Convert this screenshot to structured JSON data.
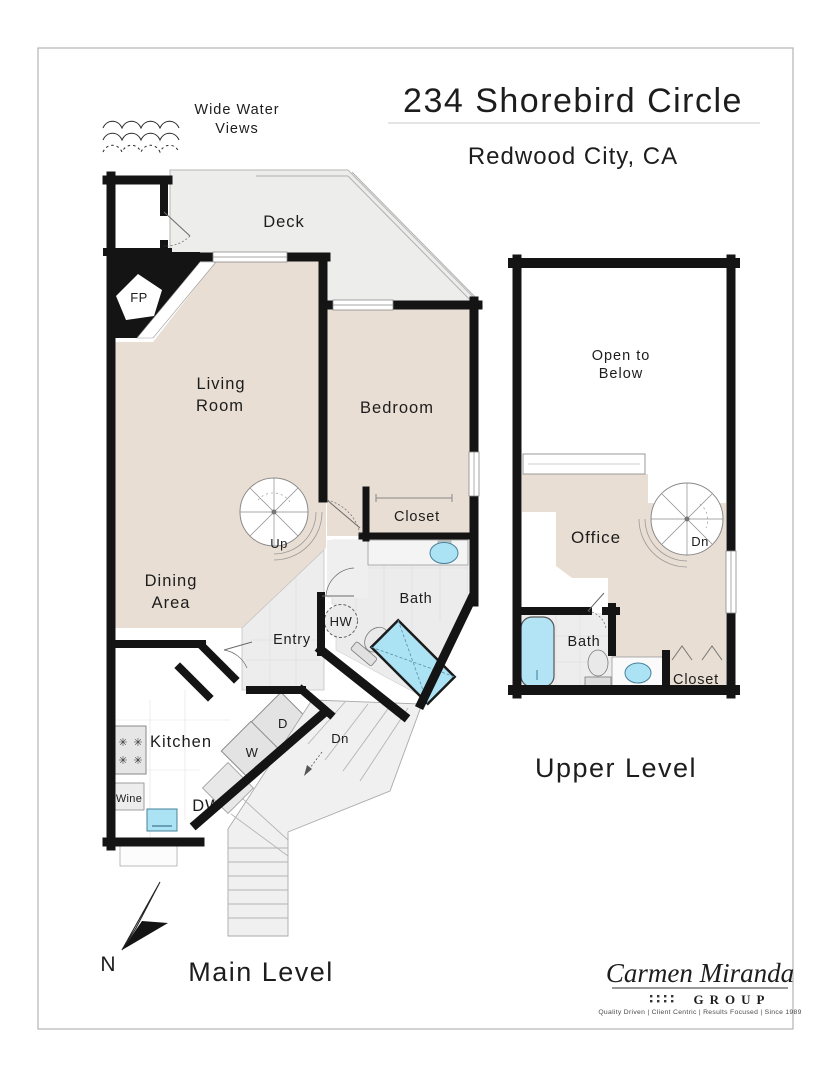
{
  "header": {
    "title": "234 Shorebird Circle",
    "subtitle": "Redwood City, CA"
  },
  "annotation": {
    "line1": "Wide Water",
    "line2": "Views"
  },
  "main_level": {
    "caption": "Main Level",
    "compass": "N",
    "rooms": {
      "closet": "Closet",
      "deck": "Deck",
      "fireplace": "FP",
      "living_1": "Living",
      "living_2": "Room",
      "bedroom": "Bedroom",
      "bedroom_closet": "Closet",
      "bath": "Bath",
      "dining_1": "Dining",
      "dining_2": "Area",
      "entry": "Entry",
      "hot_water": "HW",
      "kitchen": "Kitchen",
      "wine": "Wine",
      "dishwasher": "DW",
      "washer": "W",
      "dryer": "D",
      "up": "Up",
      "down": "Dn",
      "burner": "✳"
    }
  },
  "upper_level": {
    "caption": "Upper Level",
    "rooms": {
      "open_1": "Open to",
      "open_2": "Below",
      "office": "Office",
      "down": "Dn",
      "bath": "Bath",
      "closet": "Closet"
    }
  },
  "branding": {
    "name": "Carmen Miranda",
    "group": "GROUP",
    "tagline": "Quality Driven | Client Centric | Results Focused | Since 1989"
  },
  "colors": {
    "wall": "#141414",
    "room_fill": "#e9ded3",
    "deck_fill": "#ededeb",
    "tile_fill": "#ececec",
    "water": "#abe2f4",
    "appliance": "#e6e6e6"
  }
}
